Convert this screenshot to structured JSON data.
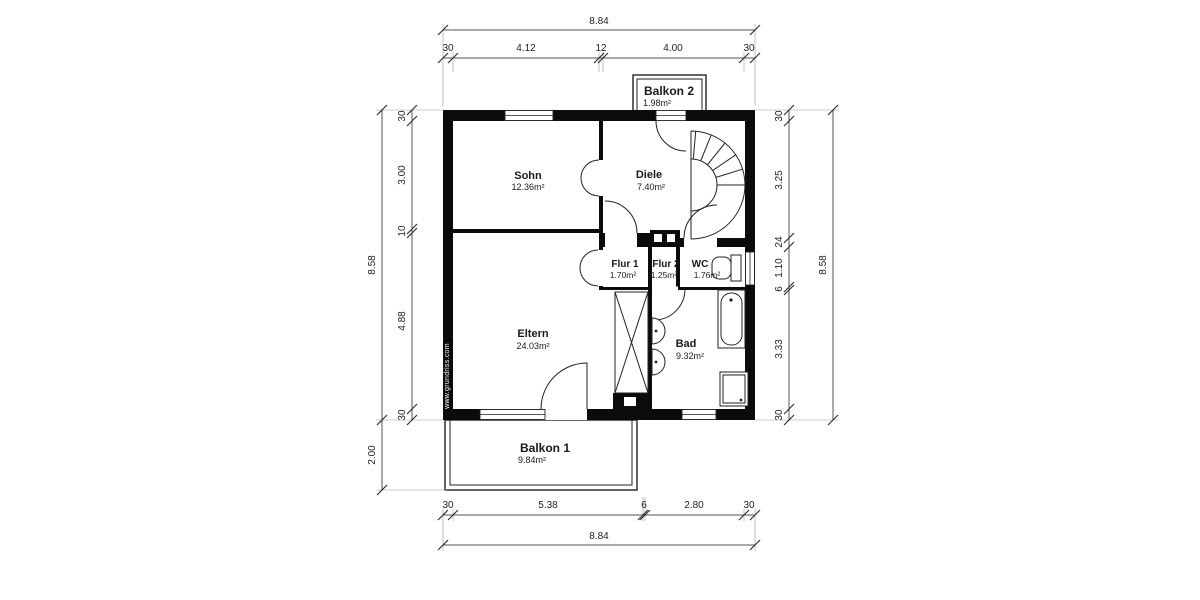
{
  "watermark": "www.grundriss.com",
  "rooms": {
    "sohn": {
      "name": "Sohn",
      "area": "12.36m²"
    },
    "diele": {
      "name": "Diele",
      "area": "7.40m²"
    },
    "flur1": {
      "name": "Flur 1",
      "area": "1.70m²"
    },
    "flur2": {
      "name": "Flur 2",
      "area": "1.25m²"
    },
    "wc": {
      "name": "WC",
      "area": "1.76m²"
    },
    "eltern": {
      "name": "Eltern",
      "area": "24.03m²"
    },
    "bad": {
      "name": "Bad",
      "area": "9.32m²"
    },
    "balkon2": {
      "name": "Balkon 2",
      "area": "1.98m²"
    },
    "balkon1": {
      "name": "Balkon 1",
      "area": "9.84m²"
    }
  },
  "dimensions": {
    "top_total": "8.84",
    "top_chain": [
      "30",
      "4.12",
      "12",
      "4.00",
      "30"
    ],
    "bottom_chain": [
      "30",
      "5.38",
      "6",
      "2.80",
      "30"
    ],
    "bottom_total": "8.84",
    "left_total": "8.58",
    "left_chain": [
      "30",
      "3.00",
      "10",
      "4.88",
      "30"
    ],
    "left_balcony_depth": "2.00",
    "right_chain": [
      "30",
      "3.25",
      "24",
      "1.10",
      "6",
      "3.33",
      "30"
    ],
    "right_total": "8.58"
  }
}
